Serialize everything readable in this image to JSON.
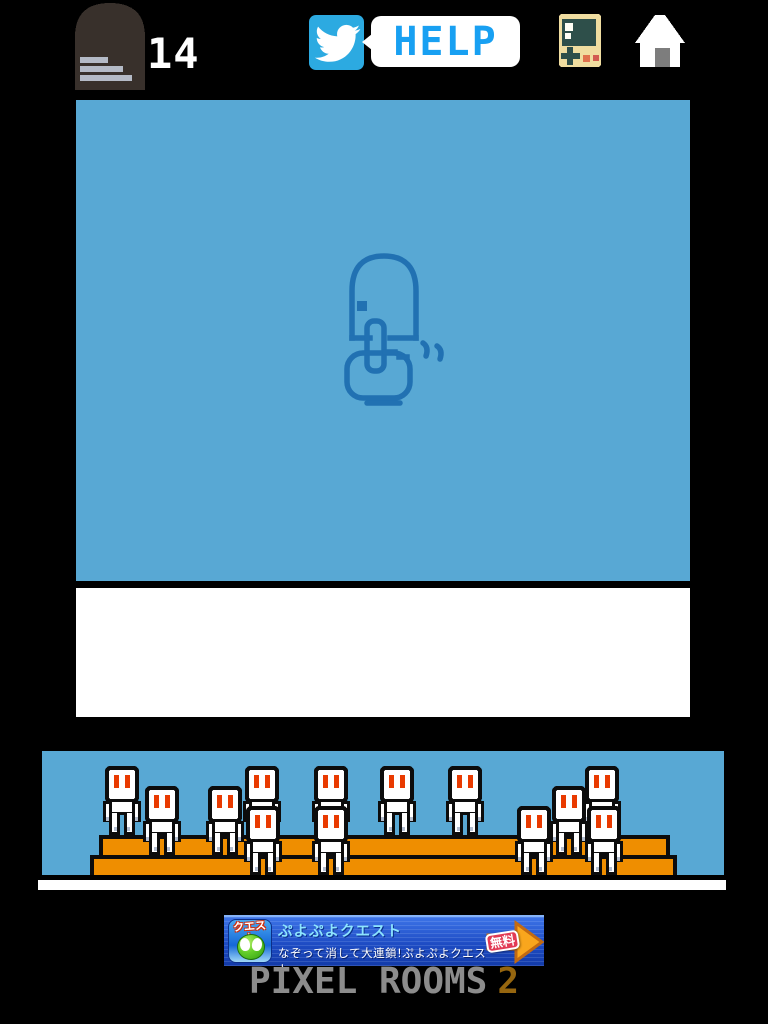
{
  "header": {
    "rooms_count": "14",
    "help_label": "HELP",
    "door_icon": "door-with-stage-list",
    "twitter_icon": "twitter-bird",
    "console_icon": "handheld-game-console",
    "home_icon": "home-house"
  },
  "game": {
    "hint_icon": "hand-tapping-door-gesture",
    "screen_color": "#58a8d4",
    "hint_line_color": "#2171b2"
  },
  "crowd": {
    "bench_color": "#ef8e00",
    "eye_color": "#e93a00",
    "accent_color": "#b5bfd1",
    "characters": [
      {
        "x": 80,
        "row": "back"
      },
      {
        "x": 220,
        "row": "back"
      },
      {
        "x": 289,
        "row": "back"
      },
      {
        "x": 355,
        "row": "back"
      },
      {
        "x": 423,
        "row": "back"
      },
      {
        "x": 560,
        "row": "back"
      },
      {
        "x": 120,
        "row": "middle"
      },
      {
        "x": 183,
        "row": "middle"
      },
      {
        "x": 527,
        "row": "middle"
      },
      {
        "x": 221,
        "row": "front"
      },
      {
        "x": 289,
        "row": "front"
      },
      {
        "x": 492,
        "row": "front"
      },
      {
        "x": 562,
        "row": "front"
      }
    ]
  },
  "ad": {
    "icon_label": "クエスト",
    "title": "ぷよぷよクエスト",
    "subtitle": "なぞって消して大連鎖!ぷよぷよクエスト",
    "cta_label": "無料",
    "arrow_color": "#f9a61d",
    "badge_color": "#e23b55"
  },
  "footer": {
    "logo_text": "PIXEL ROOMS",
    "logo_number": "2"
  },
  "colors": {
    "background": "#000000",
    "sky_blue": "#58a8d4",
    "bench_orange": "#ef8e00",
    "help_blue": "#18a0f2",
    "twitter_blue": "#2caae1",
    "footer_gray": "#8c8c8c",
    "footer_number_brown": "#96660f",
    "door_brown": "#38302b"
  }
}
